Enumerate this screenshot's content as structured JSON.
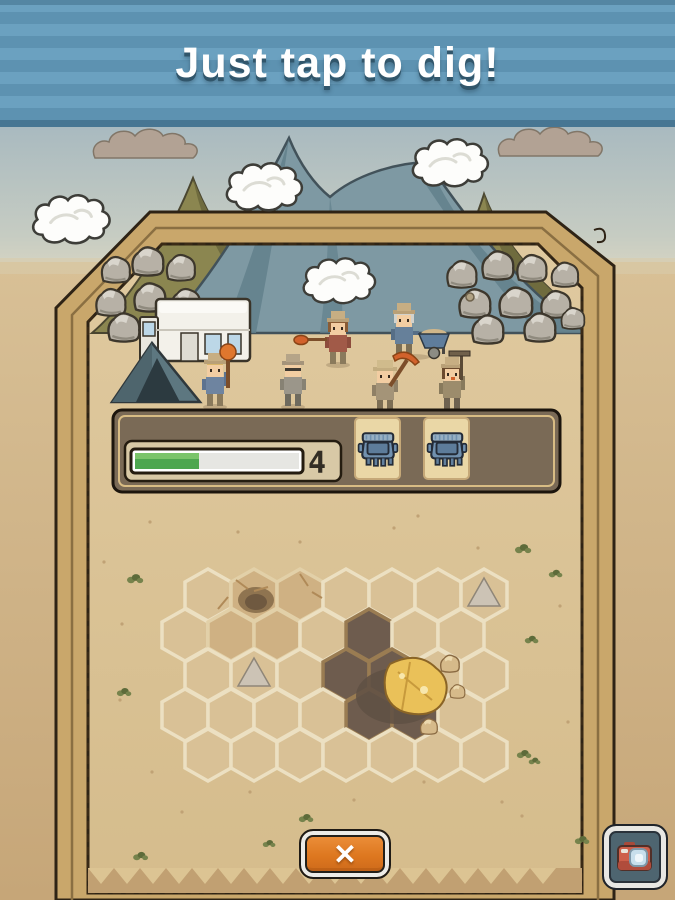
{
  "banner": {
    "title": "Just tap to dig!"
  },
  "hud": {
    "progress": {
      "label": "4",
      "percent": 39,
      "fill_color": "#4da64f"
    },
    "crate_slots": [
      {
        "icon": "crate-icon"
      },
      {
        "icon": "crate-icon"
      }
    ]
  },
  "dig_grid": {
    "rows": 5,
    "cols": 7,
    "origin": {
      "x": 208,
      "y": 595
    },
    "hex": {
      "w": 46,
      "row_h": 40
    },
    "dug_cells": [
      [
        1,
        4
      ],
      [
        2,
        3
      ],
      [
        2,
        4
      ],
      [
        3,
        4
      ],
      [
        3,
        5
      ]
    ],
    "shallow_cells": [
      [
        0,
        1
      ],
      [
        0,
        2
      ],
      [
        1,
        1
      ],
      [
        1,
        2
      ]
    ],
    "mound_cells": [
      [
        2,
        1
      ],
      [
        0,
        6
      ]
    ]
  },
  "buttons": {
    "close_label": "✕",
    "camera_icon": "camera-icon"
  },
  "palette": {
    "banner_stripe_dark": "#5d92b1",
    "banner_stripe_light": "#6ba1c0",
    "board_sand": "#dcc493",
    "frame_tan": "#c9a76b",
    "button_orange": "#e2812f",
    "progress_green": "#4da64f",
    "crate_blue": "#7191af"
  }
}
